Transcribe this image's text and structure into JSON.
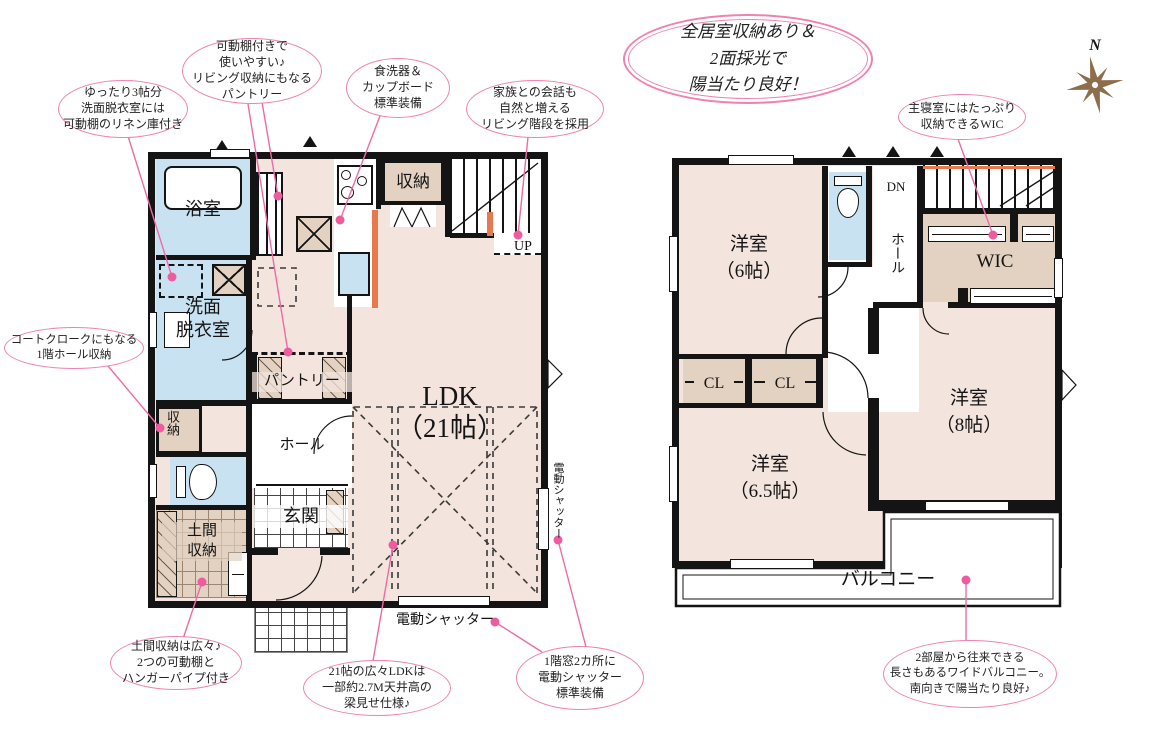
{
  "badge": {
    "text": "全居室収納あり＆\n2面採光で\n陽当たり良好！"
  },
  "compass": {
    "north": "N"
  },
  "floor1": {
    "bath": "浴室",
    "washroom": "洗面\n脱衣室",
    "pantry": "パントリー",
    "kitchen_storage": "収納",
    "hall_storage": "収納",
    "hall": "ホール",
    "entrance": "玄関",
    "doma": "土間\n収納",
    "ldk": "LDK\n（21帖）",
    "up": "UP",
    "shutter_bottom": "電動シャッター",
    "shutter_right": "電動シャッター"
  },
  "floor2": {
    "bedroom6": "洋室\n（6帖）",
    "bedroom65": "洋室\n（6.5帖）",
    "bedroom8": "洋室\n（8帖）",
    "wic": "WIC",
    "cl_left": "CL",
    "cl_right": "CL",
    "hall": "ホール",
    "dn": "DN",
    "balcony": "バルコニー"
  },
  "callouts": {
    "linen": "ゆったり3帖分\n洗面脱衣室には\n可動棚のリネン庫付き",
    "pantry": "可動棚付きで\n使いやすい♪\nリビング収納にもなる\nパントリー",
    "dishwasher": "食洗器＆\nカップボード\n標準装備",
    "living_stairs": "家族との会話も\n自然と増える\nリビング階段を採用",
    "wic": "主寝室にはたっぷり\n収納できるWIC",
    "hall_storage": "コートクロークにもなる\n1階ホール収納",
    "doma": "土間収納は広々♪\n2つの可動棚と\nハンガーパイプ付き",
    "ldk_ceiling": "21帖の広々LDKは\n一部約2.7M天井高の\n梁見せ仕様♪",
    "shutter": "1階窓2カ所に\n電動シャッター\n標準装備",
    "balcony": "2部屋から往来できる\n長さもあるワイドバルコニー。\n南向きで陽当たり良好♪"
  },
  "colors": {
    "accent_pink": "#ee5b9e",
    "room_pink": "#f3e4de",
    "closet_beige": "#e3d2c2",
    "wet_blue": "#c9e2f2",
    "wall": "#141414",
    "accent_orange": "#e8784e",
    "compass_brown": "#8d6e4b"
  }
}
